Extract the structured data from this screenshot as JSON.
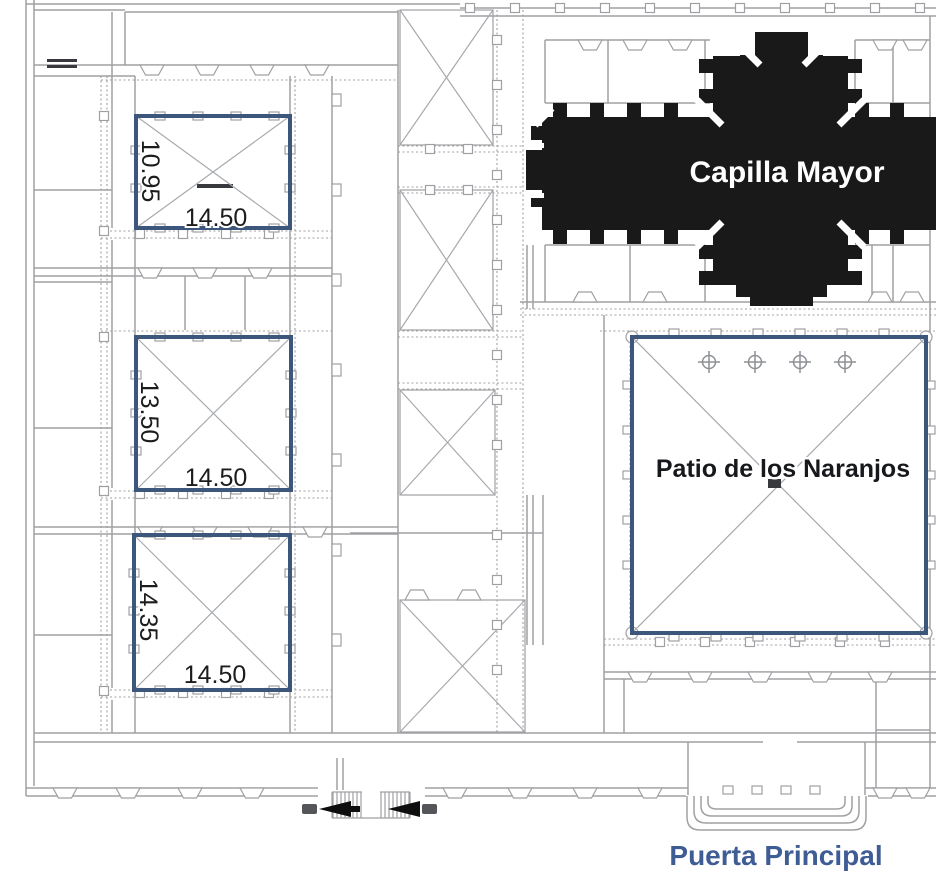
{
  "plan": {
    "type": "architectural-floor-plan",
    "labels": {
      "capilla_mayor": "Capilla Mayor",
      "patio": "Patio de los Naranjos",
      "puerta_principal": "Puerta Principal"
    },
    "courtyards": [
      {
        "position": "upper-left",
        "height_dim": "10.95",
        "width_dim": "14.50"
      },
      {
        "position": "middle-left",
        "height_dim": "13.50",
        "width_dim": "14.50"
      },
      {
        "position": "lower-left",
        "height_dim": "14.35",
        "width_dim": "14.50"
      }
    ],
    "patio_details": {
      "tree_symbol_count": 4,
      "tree_symbol": "crosshair-circle"
    },
    "side_entrance": {
      "arrow_icon": "solid-left-arrow",
      "arrow_count": 2
    },
    "colors": {
      "courtyard_border": "#3d567b",
      "capilla_fill": "#191919",
      "capilla_text": "#ffffff",
      "puerta_text": "#3f5d95",
      "dimension_text": "#1c1c1c",
      "wall_line": "#a0a0a4"
    }
  }
}
